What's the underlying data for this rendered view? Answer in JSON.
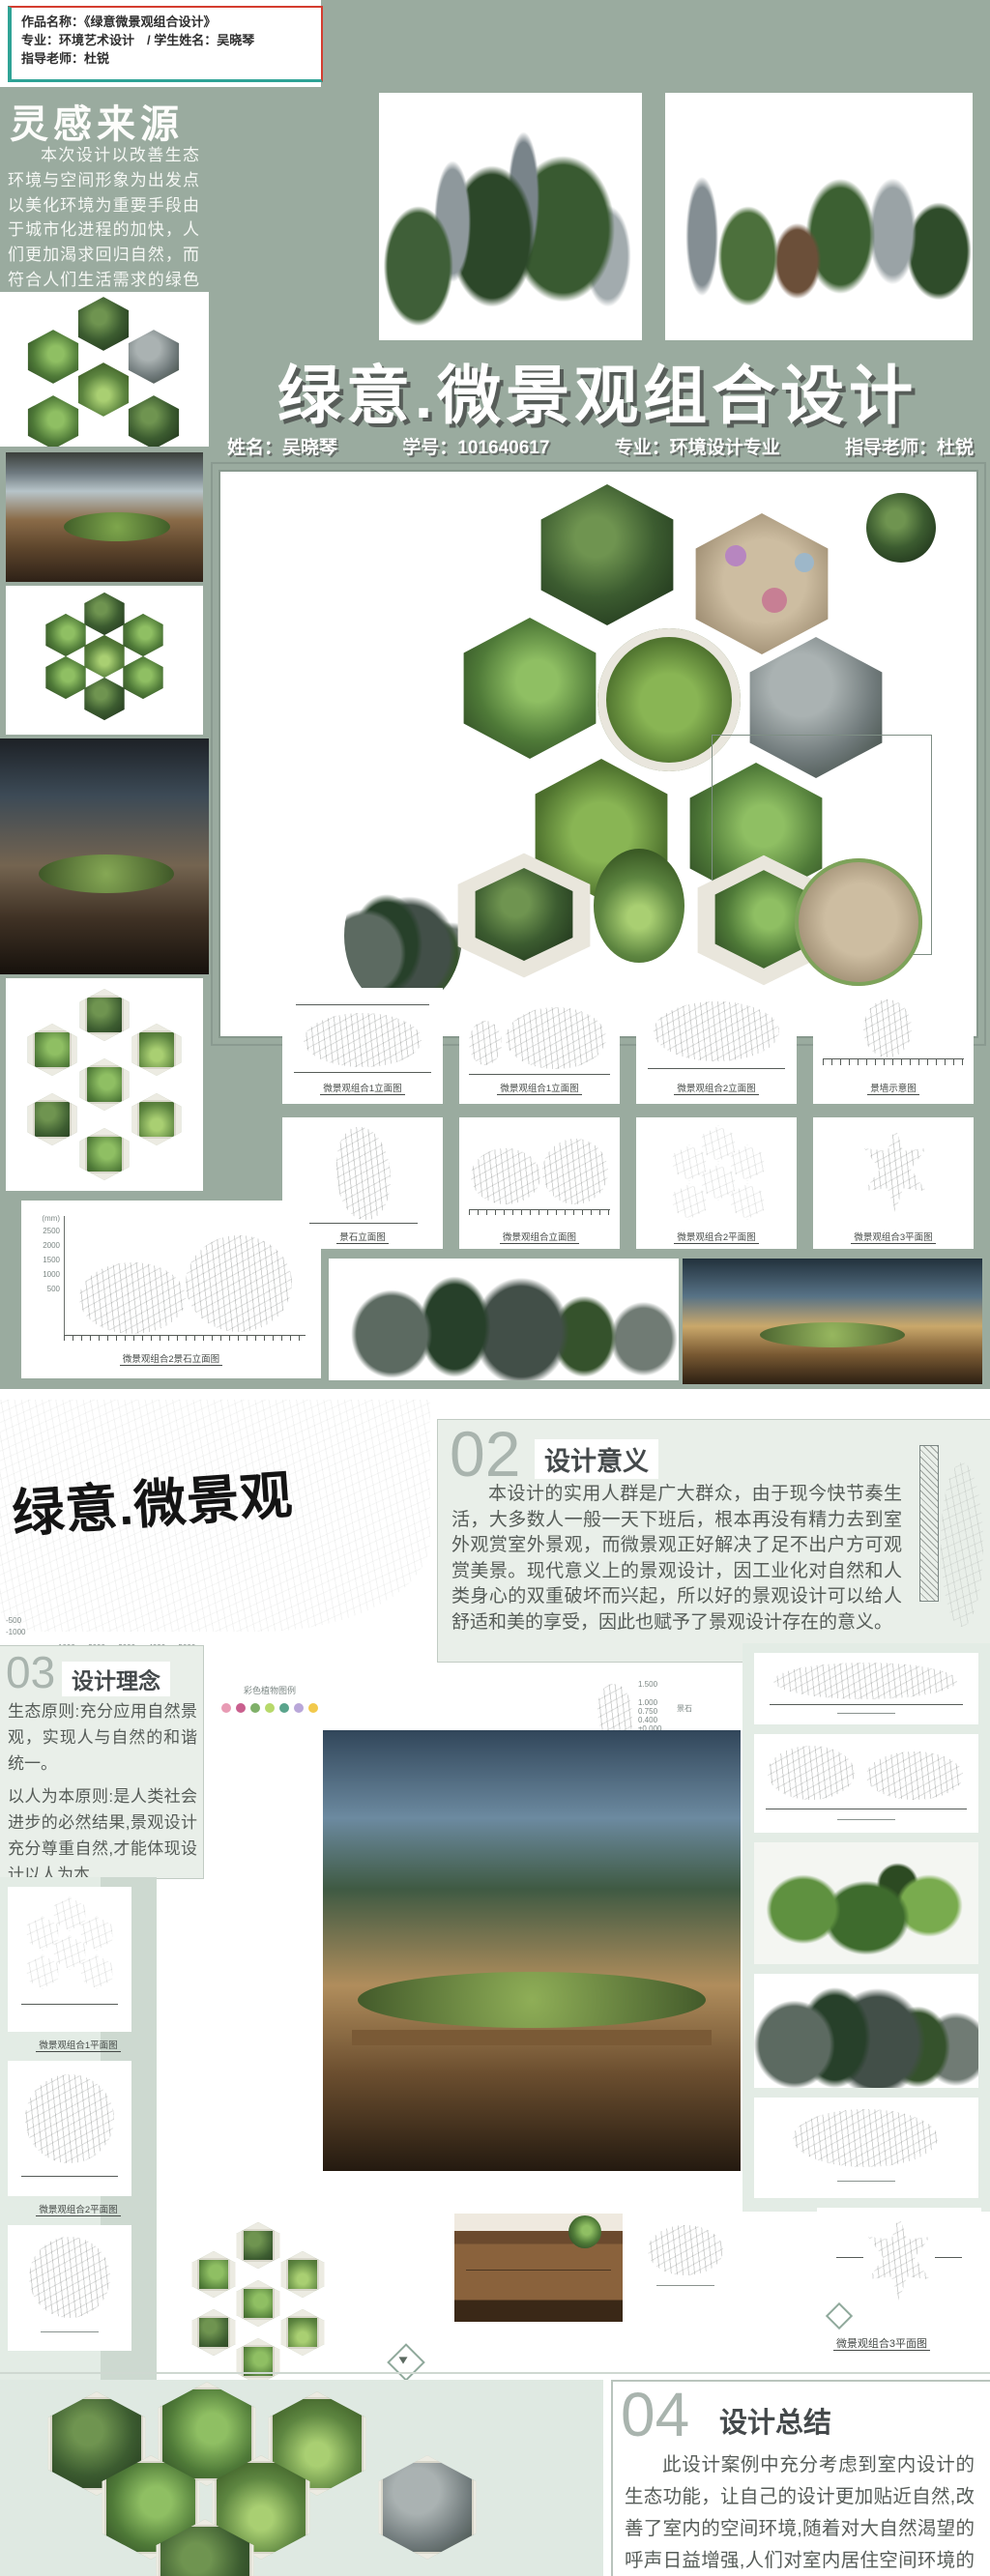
{
  "header": {
    "line1": "作品名称：《绿意微景观组合设计》",
    "line2": "专业：环境艺术设计　/ 学生姓名：吴晓琴",
    "line3": "指导老师：杜锐"
  },
  "poster": {
    "inspiration_title": "灵感来源",
    "inspiration_text": "本次设计以改善生态环境与空间形象为出发点以美化环境为重要手段由于城市化进程的加快，人们更加渴求回归自然，而符合人们生活需求的绿色设计更加被大众所接受。",
    "main_title": "绿意.微景观组合设计",
    "info": {
      "name": "姓名：吴晓琴",
      "student_id": "学号：101640617",
      "major": "专业：环境设计专业",
      "advisor": "指导老师：杜锐"
    },
    "elevation_caption": "微景观组合2景石立面图",
    "elevation_scale": [
      "(mm)",
      "2500",
      "2000",
      "1500",
      "1000",
      "500"
    ],
    "row1_captions": [
      "微景观组合1立面图",
      "微景观组合1立面图",
      "微景观组合2立面图",
      "景墙示意图"
    ],
    "row2_captions": [
      "景石立面图",
      "微景观组合立面图",
      "微景观组合2平面图",
      "微景观组合3平面图"
    ]
  },
  "lower": {
    "brush_title": "绿意.微景观",
    "sketch_axis": {
      "left1": "-500",
      "left2": "-1000",
      "bottom": "1000      2000      3000      4000      5000"
    },
    "s02": {
      "num": "02",
      "title": "设计意义",
      "text": "本设计的实用人群是广大群众，由于现今快节奏生活，大多数人一般一天下班后，根本再没有精力去到室外观赏室外景观，而微景观正好解决了足不出户方可观赏美景。现代意义上的景观设计，因工业化对自然和人类身心的双重破坏而兴起，所以好的景观设计可以给人舒适和美的享受，因此也赋予了景观设计存在的意义。"
    },
    "rockery_caption": "假山剖面图",
    "stone": {
      "caption": "景石立面图",
      "label": "景石",
      "levels": [
        "1.500",
        "1.000",
        "0.750",
        "0.400",
        "±0.000"
      ]
    },
    "s03": {
      "num": "03",
      "title": "设计理念",
      "text1": "生态原则:充分应用自然景观，实现人与自然的和谐统一。",
      "text2": "以人为本原则:是人类社会进步的必然结果,景观设计充分尊重自然,才能体现设计以人为本."
    },
    "legend_caption": "彩色植物图例",
    "plan1_caption": "微景观组合1平面图",
    "plan2_caption": "微景观组合2平面图",
    "plan3_caption": "微景观组合3平面图",
    "s04": {
      "num": "04",
      "title": "设计总结",
      "text": "此设计案例中充分考虑到室内设计的生态功能，让自己的设计更加贴近自然,改善了室内的空间环境,随着对大自然渴望的呼声日益增强,人们对室内居住空间环境的要求越来越高,由以前花草转变到要求更多的室外景观来布置他们的生活。"
    }
  },
  "colors": {
    "sage": "#9aab9f",
    "accent_red": "#d43d30",
    "accent_teal": "#2fa396"
  }
}
